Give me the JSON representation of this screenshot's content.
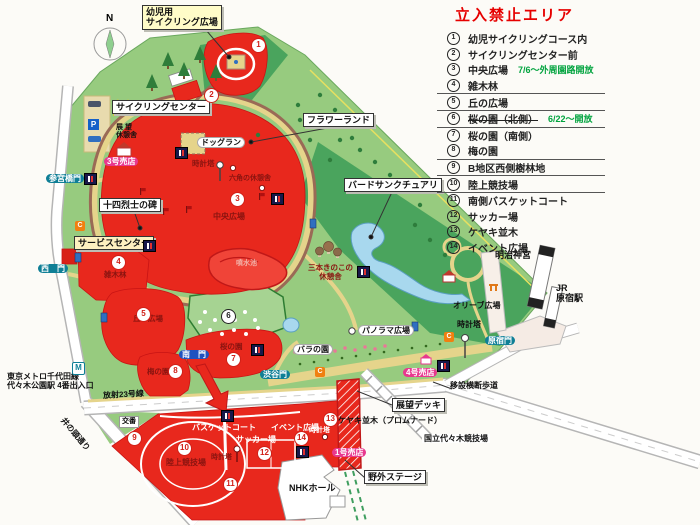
{
  "colors": {
    "restricted_red": "#e8281d",
    "dark_red_text": "#8a1410",
    "park_green": "#97cb7f",
    "forest_green": "#4aa45d",
    "released_green": "#a6d392",
    "pond_blue": "#a8d8ee",
    "path_tan": "#e5d48b",
    "cycling_brown": "#9a6a56",
    "legend_title_red": "#e60000",
    "legend_note_green": "#00a33e",
    "shop_magenta": "#e8388f",
    "gate_teal": "#0f7f96",
    "gate_blue": "#1f52c0",
    "callout_yellow": "#fffcc8"
  },
  "icons": {
    "compass": "north-compass",
    "wc": "restroom-icon",
    "tel": "public-phone-icon",
    "p": "parking-icon",
    "m": "metro-icon",
    "clock": "clock-tower-icon",
    "house": "rest-house-icon",
    "mushroom": "mushroom-shelter-icon",
    "flag": "flag-icon"
  },
  "legend": {
    "title": "立入禁止エリア",
    "items": [
      {
        "num": "1",
        "label": "幼児サイクリングコース内",
        "note": ""
      },
      {
        "num": "2",
        "label": "サイクリングセンター前",
        "note": ""
      },
      {
        "num": "3",
        "label": "中央広場",
        "note": "7/6～外周園路開放"
      },
      {
        "num": "4",
        "label": "雑木林",
        "note": ""
      },
      {
        "num": "5",
        "label": "丘の広場",
        "note": ""
      },
      {
        "num": "6",
        "label": "桜の園（北側）",
        "note": "6/22～開放"
      },
      {
        "num": "7",
        "label": "桜の園（南側）",
        "note": ""
      },
      {
        "num": "8",
        "label": "梅の園",
        "note": ""
      },
      {
        "num": "9",
        "label": "B地区西側樹林地",
        "note": ""
      },
      {
        "num": "10",
        "label": "陸上競技場",
        "note": ""
      },
      {
        "num": "11",
        "label": "南側バスケットコート",
        "note": ""
      },
      {
        "num": "12",
        "label": "サッカー場",
        "note": ""
      },
      {
        "num": "13",
        "label": "ケヤキ並木",
        "note": ""
      },
      {
        "num": "14",
        "label": "イベント広場",
        "note": ""
      }
    ]
  },
  "map": {
    "compass_n": "N",
    "badges": [
      {
        "n": "1"
      },
      {
        "n": "2"
      },
      {
        "n": "3"
      },
      {
        "n": "4"
      },
      {
        "n": "5"
      },
      {
        "n": "6"
      },
      {
        "n": "7"
      },
      {
        "n": "8"
      },
      {
        "n": "9"
      },
      {
        "n": "10"
      },
      {
        "n": "11"
      },
      {
        "n": "12"
      },
      {
        "n": "13"
      },
      {
        "n": "14"
      }
    ],
    "labels": {
      "kids_cycling": {
        "text": "幼児用\nサイクリング広場"
      },
      "cycling_center": {
        "text": "サイクリングセンター"
      },
      "flower_land": {
        "text": "フラワーランド"
      },
      "bird_sanctuary": {
        "text": "バードサンクチュアリ"
      },
      "monument": {
        "text": "十四烈士の碑"
      },
      "lookout_deck": {
        "text": "展望デッキ"
      },
      "outdoor_stage": {
        "text": "野外ステージ"
      },
      "service_center": {
        "text": "サービスセンター"
      },
      "dog_run": {
        "text": "ドッグラン"
      },
      "panorama": {
        "text": "パノラマ広場"
      },
      "rose_garden": {
        "text": "バラの園"
      },
      "koban": {
        "text": "交番"
      },
      "shop3": {
        "text": "3号売店"
      },
      "shop4": {
        "text": "4号売店"
      },
      "shop1": {
        "text": "1号売店"
      },
      "gate_sangubashi": {
        "text": "参宮橋門"
      },
      "gate_west": {
        "text": "西　門"
      },
      "gate_shibuya": {
        "text": "渋谷門"
      },
      "gate_harajuku": {
        "text": "原宿門"
      },
      "gate_south": {
        "text": "南　門"
      },
      "meiji_jingu": {
        "text": "明治神宮"
      },
      "jr_harajuku": {
        "text": "JR\n原宿駅"
      },
      "metro": {
        "text": "東京メトロ千代田線\n代々木公園駅 4番出入口"
      },
      "inokashira_st": {
        "text": "井の頭通り"
      },
      "hosha23": {
        "text": "放射23号線"
      },
      "isetsu_crossing": {
        "text": "移設横断歩道"
      },
      "yoyogi_stadium": {
        "text": "国立代々木競技場"
      },
      "nhk_hall": {
        "text": "NHKホール"
      },
      "keyaki": {
        "text": "ケヤキ並木（プロムナード）"
      },
      "tenbo_kyukeisha": {
        "text": "展 望\n休憩舎"
      },
      "clock_central": {
        "text": "時計塔"
      },
      "clock_east": {
        "text": "時計塔"
      },
      "clock_b": {
        "text": "時計塔"
      },
      "clock_event": {
        "text": "時計塔"
      },
      "olive": {
        "text": "オリーブ広場"
      },
      "central_plaza": {
        "text": "中央広場"
      },
      "hex_house": {
        "text": "六角の休憩舎"
      },
      "fountain_pond": {
        "text": "噴水池"
      },
      "zokibayashi": {
        "text": "雑木林"
      },
      "oka_hiroba": {
        "text": "丘の広場"
      },
      "sakura_south": {
        "text": "桜の園"
      },
      "ume_garden": {
        "text": "梅の園"
      },
      "rikujo": {
        "text": "陸上競技場"
      },
      "basket_court": {
        "text": "バスケットコート"
      },
      "soccer": {
        "text": "サッカー場"
      },
      "event_square": {
        "text": "イベント広場"
      },
      "mushroom_house": {
        "text": "三本きのこの\n休憩舎"
      }
    }
  }
}
